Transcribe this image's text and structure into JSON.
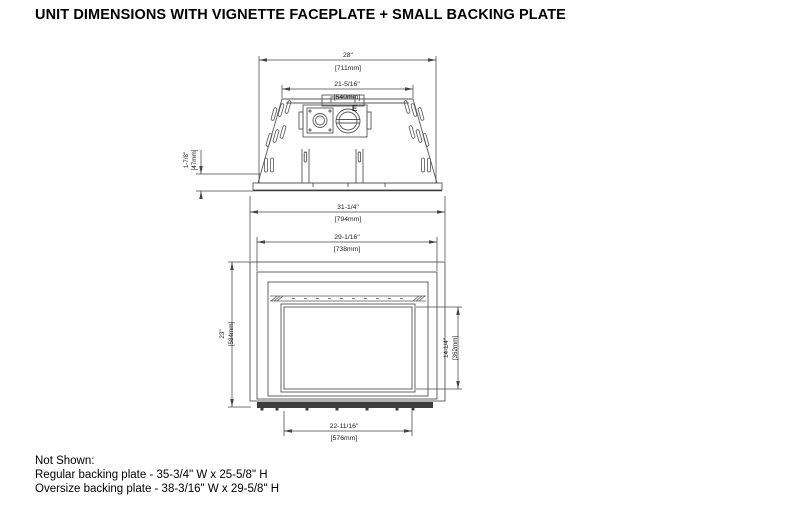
{
  "page": {
    "title": "UNIT DIMENSIONS WITH VIGNETTE FACEPLATE + SMALL BACKING PLATE"
  },
  "colors": {
    "line": "#555555",
    "dimension": "#444444",
    "text": "#000000",
    "dark_bar": "#3d3d3d",
    "background": "#ffffff"
  },
  "top_view": {
    "dim_overall_width_in": "28\"",
    "dim_overall_width_mm": "[711mm]",
    "dim_top_width_in": "21-5/16\"",
    "dim_top_width_mm": "[540mm]",
    "dim_plate_height_in": "1-7/8\"",
    "dim_plate_height_mm": "[47mm]",
    "flue_label": "E"
  },
  "front_view": {
    "dim_backing_width_in": "31-1/4\"",
    "dim_backing_width_mm": "[794mm]",
    "dim_faceplate_width_in": "29-1/16\"",
    "dim_faceplate_width_mm": "[738mm]",
    "dim_overall_height_in": "23\"",
    "dim_overall_height_mm": "[584mm]",
    "dim_opening_height_in": "14-1/4\"",
    "dim_opening_height_mm": "[362mm]",
    "dim_opening_width_in": "22-11/16\"",
    "dim_opening_width_mm": "[576mm]"
  },
  "notes": {
    "heading": "Not Shown:",
    "regular": "Regular backing plate - 35-3/4\" W x 25-5/8\" H",
    "oversize": "Oversize backing plate - 38-3/16\" W x 29-5/8\" H"
  }
}
